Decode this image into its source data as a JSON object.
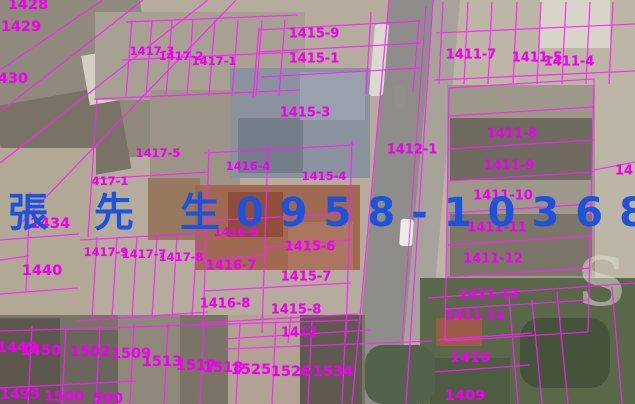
{
  "watermark": {
    "text": "張 先 生0958-103680",
    "color": "#1d53db"
  },
  "corner_mark": {
    "text": "S"
  },
  "map": {
    "line_color": "#ff1dff",
    "label_color": "#ee00ee",
    "labels": [
      {
        "text": "1428"
      },
      {
        "text": "1429"
      },
      {
        "text": "430"
      },
      {
        "text": "1417-3"
      },
      {
        "text": "1417-2"
      },
      {
        "text": "1417-1"
      },
      {
        "text": "1415-9"
      },
      {
        "text": "1415-1"
      },
      {
        "text": "1411-7"
      },
      {
        "text": "1411-5"
      },
      {
        "text": "1411-4"
      },
      {
        "text": "1415-3"
      },
      {
        "text": "1417-5"
      },
      {
        "text": "417-1"
      },
      {
        "text": "1416-4"
      },
      {
        "text": "1415-4"
      },
      {
        "text": "1412-1"
      },
      {
        "text": "1434"
      },
      {
        "text": "1440"
      },
      {
        "text": "1417-9"
      },
      {
        "text": "1417-7"
      },
      {
        "text": "1417-8"
      },
      {
        "text": "1416-6"
      },
      {
        "text": "1415-6"
      },
      {
        "text": "1416-7"
      },
      {
        "text": "1415-7"
      },
      {
        "text": "1416-8"
      },
      {
        "text": "1415-8"
      },
      {
        "text": "1412"
      },
      {
        "text": "1411-8"
      },
      {
        "text": "1411-9"
      },
      {
        "text": "1411-10"
      },
      {
        "text": "1411-11"
      },
      {
        "text": "1411-12"
      },
      {
        "text": "1411-13"
      },
      {
        "text": "1411-14"
      },
      {
        "text": "1410"
      },
      {
        "text": "1409"
      },
      {
        "text": "14"
      },
      {
        "text": "1449"
      },
      {
        "text": "1450"
      },
      {
        "text": "1502"
      },
      {
        "text": "1509"
      },
      {
        "text": "1513"
      },
      {
        "text": "1517"
      },
      {
        "text": "1518"
      },
      {
        "text": "1525"
      },
      {
        "text": "1526"
      },
      {
        "text": "1534"
      },
      {
        "text": "1495"
      },
      {
        "text": "1500"
      },
      {
        "text": "500"
      }
    ]
  }
}
